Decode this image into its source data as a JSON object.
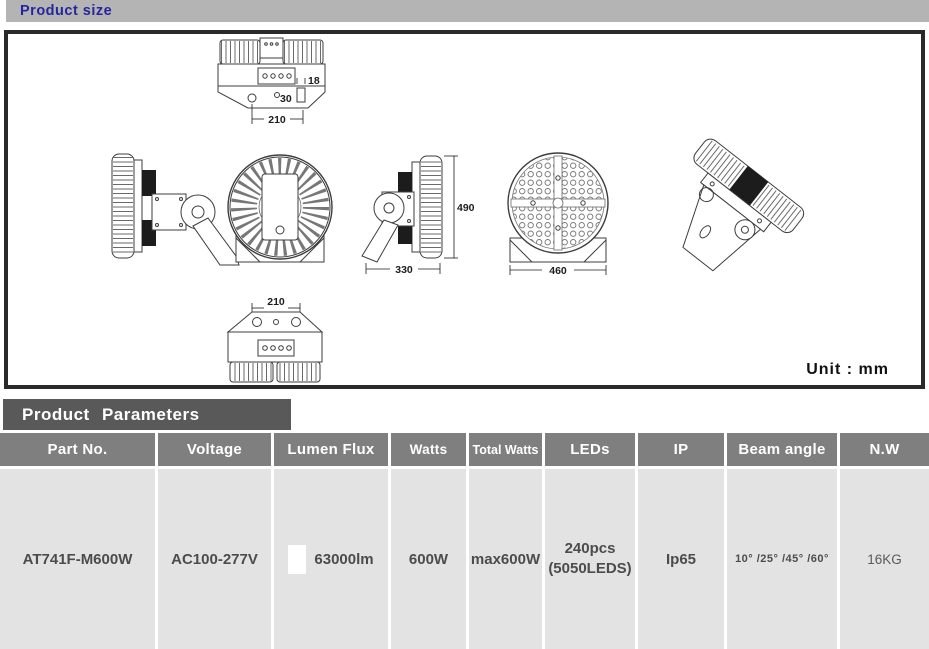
{
  "header": {
    "title": "Product size"
  },
  "drawing": {
    "unit_label": "Unit : mm",
    "dimensions": {
      "top_offset": "18",
      "top_inset": "30",
      "top_width": "210",
      "side_height": "490",
      "side_width": "330",
      "front_diameter": "460",
      "bottom_width": "210"
    }
  },
  "parameters": {
    "title": "Product Parameters",
    "columns": [
      "Part No.",
      "Voltage",
      "Lumen Flux",
      "Watts",
      "Total Watts",
      "LEDs",
      "IP",
      "Beam angle",
      "N.W"
    ],
    "row": {
      "part_no": "AT741F-M600W",
      "voltage": "AC100-277V",
      "lumen_flux": "63000lm",
      "watts": "600W",
      "total_watts": "max600W",
      "leds": "240pcs",
      "leds_detail": "(5050LEDS)",
      "ip": "Ip65",
      "beam_angle": "10° /25° /45° /60°",
      "net_weight": "16KG"
    }
  },
  "colors": {
    "top_bar_bg": "#b4b4b4",
    "top_bar_text": "#26269c",
    "panel_border": "#2a2a2a",
    "params_title_bg": "#595959",
    "table_header_bg": "#7f7f7f",
    "table_cell_bg": "#e3e3e3",
    "body_text": "#4c4c4c",
    "lumen_swatch": "#ffffff"
  }
}
